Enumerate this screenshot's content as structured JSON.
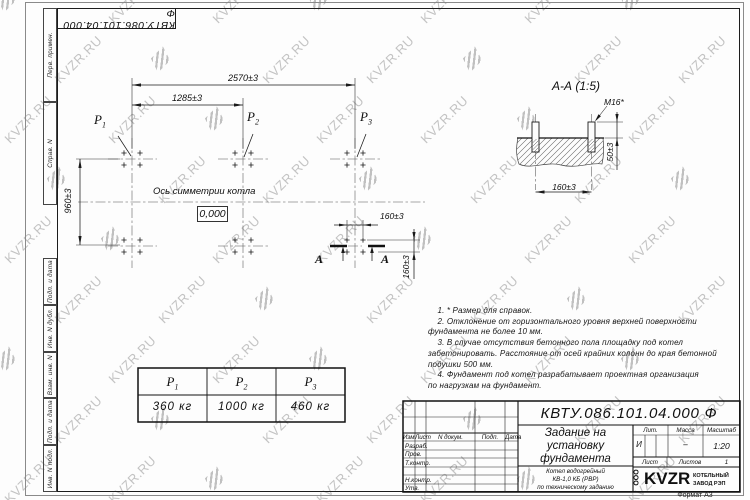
{
  "watermark": {
    "text": "KVZR.RU"
  },
  "frame": {
    "margin_labels": [
      "Перв. примен.",
      "Справ. N",
      "Подп. и дата",
      "Инв. N дубл.",
      "Взам. инв. N",
      "Подп. и дата",
      "Инв. N подл."
    ],
    "format_label": "Формат А3"
  },
  "plan": {
    "dim_total": "2570±3",
    "dim_half": "1285±3",
    "dim_depth": "960±3",
    "dim_bolt_x": "160±3",
    "dim_bolt_y": "160±3",
    "axis_label": "Ось симметрии котла",
    "elevation": "0,000",
    "section_letter": "А"
  },
  "loads": [
    {
      "name": "P",
      "sub": "1",
      "value": "360 кг"
    },
    {
      "name": "P",
      "sub": "2",
      "value": "1000 кг"
    },
    {
      "name": "P",
      "sub": "3",
      "value": "460 кг"
    }
  ],
  "section_view": {
    "title": "А-А (1:5)",
    "bolt_thread": "M16*",
    "dim_protrusion": "50±3",
    "dim_spacing": "160±3"
  },
  "notes": {
    "lines": [
      "    1. * Размер для справок.",
      "    2. Отклонение от горизонтального уровня верхней поверхности",
      "фундамента не более 10 мм.",
      "    3. В случае отсутствия бетонного пола площадку под котел",
      "забетонировать. Расстояние от осей крайних колонн до края бетонной",
      "подушки 500 мм.",
      "    4. Фундамент под котел разрабатывает проектная организация",
      "по нагрузкам на фундамент."
    ]
  },
  "title_block": {
    "doc_number": "КВТУ.086.101.04.000  Ф",
    "title_lines": [
      "Задание на",
      "установку",
      "фундамента"
    ],
    "rev_headers": [
      "Изм.",
      "Лист",
      "N докум.",
      "Подп.",
      "Дата"
    ],
    "row_labels": [
      "Разраб.",
      "Пров.",
      "Т.контр.",
      "Н.контр.",
      "Утв."
    ],
    "lit_label": "Лит.",
    "lit_value": "И",
    "mass_label": "Масса",
    "mass_value": "–",
    "scale_label": "Масштаб",
    "scale_value": "1:20",
    "sheet_label": "Лист",
    "sheets_label": "Листов",
    "sheets_value": "1",
    "product_lines": [
      "Котел водогрейный",
      "КВ-1,0 КБ (РВР)",
      "по техническому заданию"
    ],
    "logo": {
      "ooo": "ООО",
      "name": "KVZR",
      "org_line1": "КОТЕЛЬНЫЙ",
      "org_line2": "ЗАВОД РЭП"
    }
  }
}
